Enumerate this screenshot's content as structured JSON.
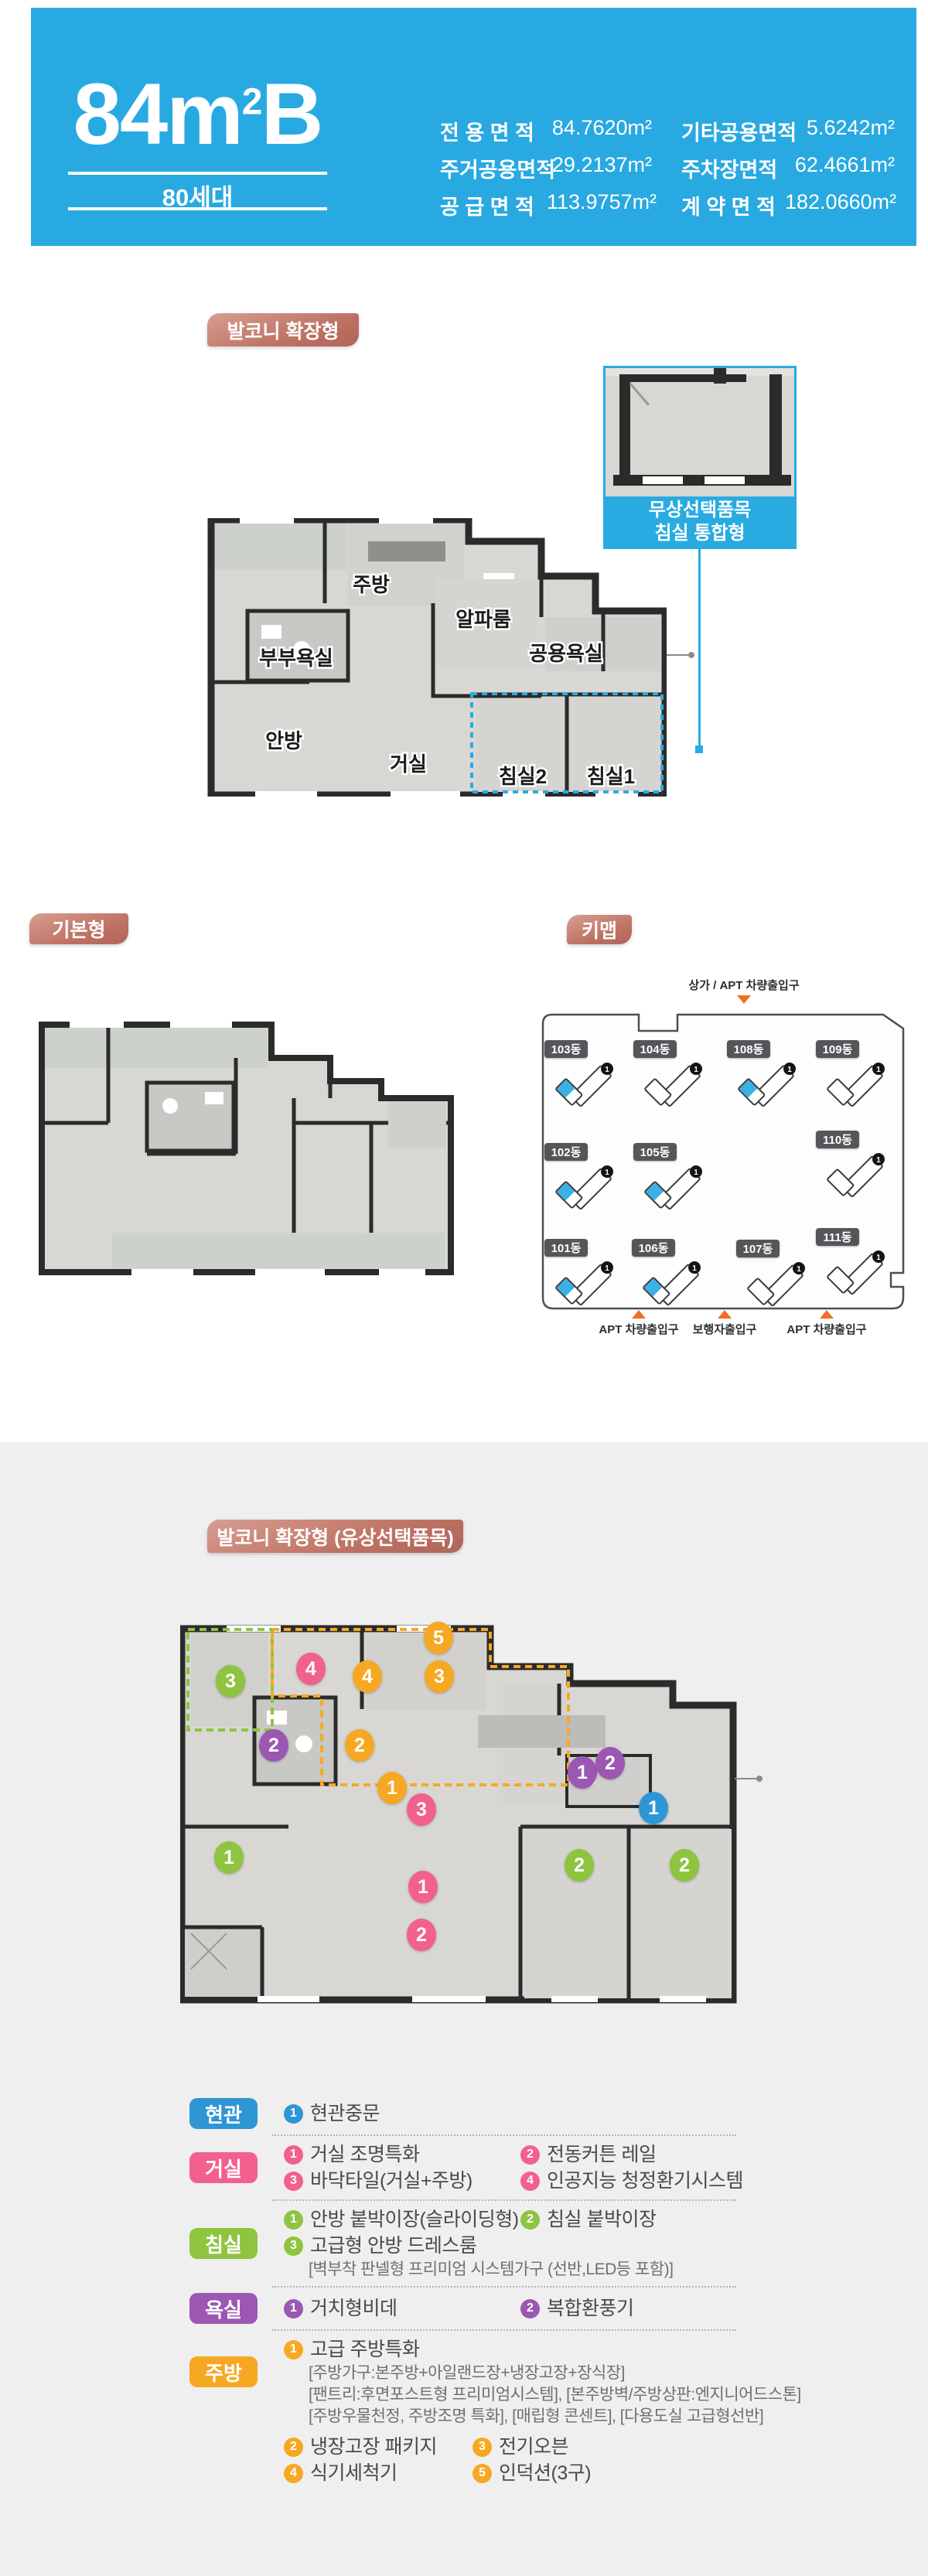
{
  "header": {
    "title_main": "84m",
    "title_sup": "2",
    "title_tail": "B",
    "units": "80세대",
    "areas": [
      {
        "label": "전 용 면 적",
        "value": "84.7620m²"
      },
      {
        "label": "기타공용면적",
        "value": "5.6242m²"
      },
      {
        "label": "주거공용면적",
        "value": "29.2137m²"
      },
      {
        "label": "주차장면적",
        "value": "62.4661m²"
      },
      {
        "label": "공 급 면 적",
        "value": "113.9757m²"
      },
      {
        "label": "계 약 면 적",
        "value": "182.0660m²"
      }
    ]
  },
  "sections": {
    "balcony_extended": "발코니 확장형",
    "basic": "기본형",
    "keymap": "키맵",
    "paid_options": "발코니 확장형 (유상선택품목)"
  },
  "plan1": {
    "rooms": {
      "kitchen": "주방",
      "alpha": "알파룸",
      "master_bath": "부부욕실",
      "common_bath": "공용욕실",
      "master": "안방",
      "living": "거실",
      "bed2": "침실2",
      "bed1": "침실1"
    }
  },
  "callout": {
    "line1": "무상선택품목",
    "line2": "침실 통합형"
  },
  "keymap": {
    "top_entrance": "상가 / APT 차량출입구",
    "bottom_entrances": [
      "APT 차량출입구",
      "보행자출입구",
      "APT 차량출입구"
    ],
    "unit_no": "1",
    "buildings": [
      {
        "name": "103동",
        "highlighted": true
      },
      {
        "name": "104동",
        "highlighted": false
      },
      {
        "name": "108동",
        "highlighted": true
      },
      {
        "name": "109동",
        "highlighted": false
      },
      {
        "name": "102동",
        "highlighted": true
      },
      {
        "name": "105동",
        "highlighted": true
      },
      {
        "name": "110동",
        "highlighted": false
      },
      {
        "name": "101동",
        "highlighted": true
      },
      {
        "name": "106동",
        "highlighted": true
      },
      {
        "name": "107동",
        "highlighted": false
      },
      {
        "name": "111동",
        "highlighted": false
      }
    ]
  },
  "plan3_markers": [
    {
      "n": "3",
      "group": "bedroom"
    },
    {
      "n": "4",
      "group": "living"
    },
    {
      "n": "5",
      "group": "kitchen"
    },
    {
      "n": "4",
      "group": "kitchen"
    },
    {
      "n": "3",
      "group": "kitchen"
    },
    {
      "n": "2",
      "group": "bath"
    },
    {
      "n": "2",
      "group": "kitchen"
    },
    {
      "n": "1",
      "group": "kitchen"
    },
    {
      "n": "3",
      "group": "living"
    },
    {
      "n": "1",
      "group": "bath"
    },
    {
      "n": "2",
      "group": "bath"
    },
    {
      "n": "1",
      "group": "entrance"
    },
    {
      "n": "1",
      "group": "bedroom"
    },
    {
      "n": "1",
      "group": "living"
    },
    {
      "n": "2",
      "group": "living"
    },
    {
      "n": "2",
      "group": "bedroom"
    },
    {
      "n": "2",
      "group": "bedroom"
    }
  ],
  "legend": {
    "groups": [
      {
        "label": "현관",
        "rows": [
          [
            {
              "n": "1",
              "text": "현관중문"
            }
          ]
        ]
      },
      {
        "label": "거실",
        "rows": [
          [
            {
              "n": "1",
              "text": "거실 조명특화"
            },
            {
              "n": "2",
              "text": "전동커튼 레일"
            }
          ],
          [
            {
              "n": "3",
              "text": "바닥타일(거실+주방)"
            },
            {
              "n": "4",
              "text": "인공지능 청정환기시스템"
            }
          ]
        ]
      },
      {
        "label": "침실",
        "rows": [
          [
            {
              "n": "1",
              "text": "안방 붙박이장(슬라이딩형)"
            },
            {
              "n": "2",
              "text": "침실 붙박이장"
            }
          ],
          [
            {
              "n": "3",
              "text": "고급형 안방 드레스룸"
            }
          ]
        ],
        "notes": [
          "[벽부착 판넬형 프리미엄 시스템가구 (선반,LED등 포함)]"
        ]
      },
      {
        "label": "욕실",
        "rows": [
          [
            {
              "n": "1",
              "text": "거치형비데"
            },
            {
              "n": "2",
              "text": "복합환풍기"
            }
          ]
        ]
      },
      {
        "label": "주방",
        "rows": [
          [
            {
              "n": "1",
              "text": "고급 주방특화"
            }
          ],
          [
            {
              "n": "2",
              "text": "냉장고장 패키지"
            },
            {
              "n": "3",
              "text": "전기오븐"
            }
          ],
          [
            {
              "n": "4",
              "text": "식기세척기"
            },
            {
              "n": "5",
              "text": "인덕션(3구)"
            }
          ]
        ],
        "notes": [
          "[주방가구:본주방+아일랜드장+냉장고장+장식장]",
          "[팬트리:후면포스트형 프리미엄시스템], [본주방벽/주방상판:엔지니어드스톤]",
          "[주방우물천정, 주방조명 특화], [매립형 콘센트], [다용도실 고급형선반]"
        ]
      }
    ]
  },
  "colors": {
    "header_cyan": "#29A9E1",
    "callout_cyan": "#29ABE2",
    "section_label_brown": "#BD7162",
    "entrance_blue": "#2E96D5",
    "living_pink": "#F2618E",
    "bedroom_green": "#8EC43F",
    "bath_purple": "#9C57B2",
    "kitchen_orange": "#F7A823",
    "keymap_badge_gray": "#55565A",
    "gate_arrow_orange": "#F26E21"
  }
}
